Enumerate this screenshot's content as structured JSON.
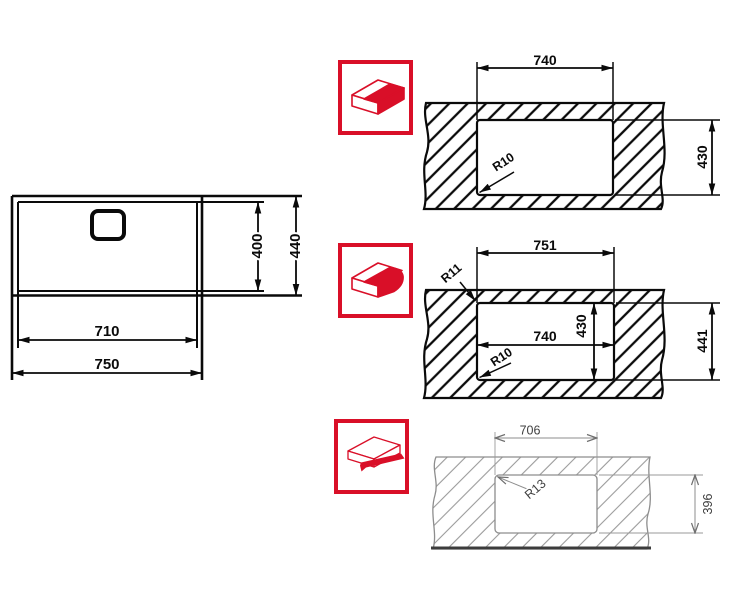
{
  "page": {
    "background": "#ffffff",
    "description": "Sink installation cutout dimension drawings"
  },
  "colors": {
    "line_black": "#0a0a0a",
    "line_gray": "#8d8d8d",
    "text_gray": "#3f3f3f",
    "accent_red": "#d90f28"
  },
  "icons": {
    "undermount": "undermount-sink-icon",
    "flush_mount": "flush-mount-sink-icon",
    "top_mount": "top-mount-sink-icon"
  },
  "sink_top_view": {
    "bowl_width": "710",
    "overall_width": "750",
    "bowl_depth": "400",
    "overall_depth": "440"
  },
  "installations": {
    "undermount": {
      "cutout_width": "740",
      "cutout_height": "430",
      "corner_radius": "R10"
    },
    "flush_mount": {
      "recess_width": "751",
      "recess_height": "441",
      "cutout_width": "740",
      "cutout_height": "430",
      "recess_corner_radius": "R11",
      "cutout_corner_radius": "R10"
    },
    "top_mount": {
      "cutout_width": "706",
      "cutout_height": "396",
      "corner_radius": "R13"
    }
  }
}
